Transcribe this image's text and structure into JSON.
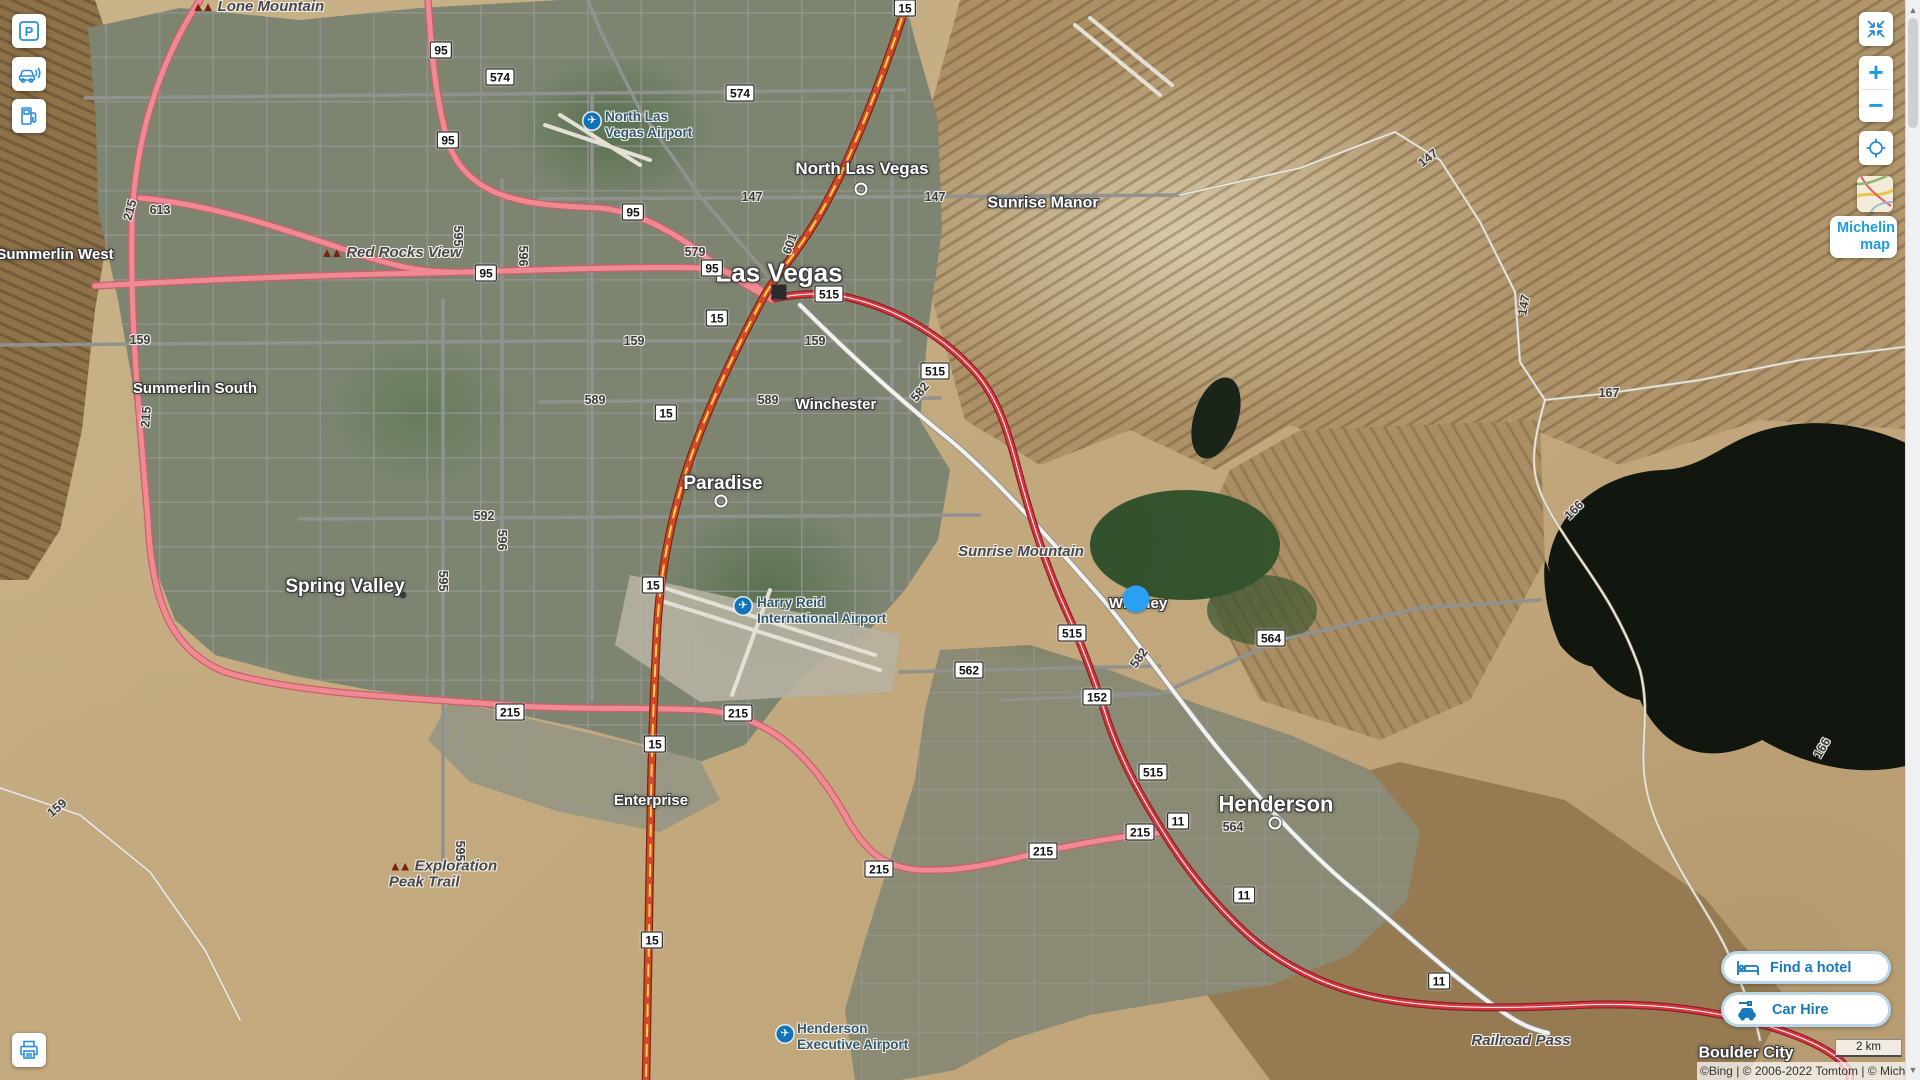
{
  "ui": {
    "left_toolbar": {
      "parking_tooltip": "Parking",
      "traffic_tooltip": "Traffic",
      "fuel_tooltip": "Petrol stations",
      "print_tooltip": "Print"
    },
    "right_toolbar": {
      "collapse_tooltip": "Collapse",
      "zoom_in_label": "+",
      "zoom_out_label": "−",
      "locate_tooltip": "My location",
      "map_style_label": "Michelin map"
    },
    "bottom_right": {
      "find_hotel_label": "Find a hotel",
      "car_hire_label": "Car Hire"
    },
    "scale_label": "2 km",
    "copyright": "©Bing | © 2006-2022 Tomtom | © Michelin"
  },
  "map": {
    "cities": [
      {
        "label": "Las Vegas",
        "x": 779,
        "y": 273,
        "fs": 26,
        "marker": {
          "t": "square",
          "x": 779,
          "y": 292
        }
      },
      {
        "label": "North Las Vegas",
        "x": 862,
        "y": 169,
        "fs": 17,
        "marker": {
          "t": "ring",
          "x": 861,
          "y": 189
        }
      },
      {
        "label": "Sunrise Manor",
        "x": 1043,
        "y": 204,
        "fs": 16,
        "marker": null
      },
      {
        "label": "Winchester",
        "x": 836,
        "y": 405,
        "fs": 15,
        "marker": null
      },
      {
        "label": "Paradise",
        "x": 723,
        "y": 484,
        "fs": 19,
        "marker": {
          "t": "ring",
          "x": 721,
          "y": 501
        }
      },
      {
        "label": "Spring Valley",
        "x": 345,
        "y": 587,
        "fs": 19,
        "marker": {
          "t": "dot",
          "x": 403,
          "y": 595
        }
      },
      {
        "label": "Summerlin West",
        "x": 55,
        "y": 255,
        "fs": 15,
        "marker": null
      },
      {
        "label": "Summerlin South",
        "x": 195,
        "y": 389,
        "fs": 15,
        "marker": null
      },
      {
        "label": "Whitney",
        "x": 1138,
        "y": 604,
        "fs": 15,
        "marker": null
      },
      {
        "label": "Enterprise",
        "x": 651,
        "y": 801,
        "fs": 15,
        "marker": null
      },
      {
        "label": "Henderson",
        "x": 1276,
        "y": 804,
        "fs": 22,
        "marker": {
          "t": "ring",
          "x": 1275,
          "y": 823
        }
      },
      {
        "label": "Boulder City",
        "x": 1746,
        "y": 1054,
        "fs": 16,
        "marker": null
      }
    ],
    "places": [
      {
        "lines": [
          "Lone Mountain"
        ],
        "x": 258,
        "y": 7,
        "icon": true
      },
      {
        "lines": [
          "Red Rocks View"
        ],
        "x": 391,
        "y": 253,
        "icon": true
      },
      {
        "lines": [
          "Sunrise Mountain"
        ],
        "x": 1021,
        "y": 552,
        "icon": false
      },
      {
        "lines": [
          "Exploration",
          "Peak Trail"
        ],
        "x": 443,
        "y": 874,
        "icon": true
      },
      {
        "lines": [
          "Railroad Pass"
        ],
        "x": 1521,
        "y": 1041,
        "icon": false
      }
    ],
    "airports": [
      {
        "lines": [
          "North Las",
          "Vegas Airport"
        ],
        "x": 605,
        "y": 109,
        "ix": 592,
        "iy": 121
      },
      {
        "lines": [
          "Harry Reid",
          "International Airport"
        ],
        "x": 757,
        "y": 595,
        "ix": 743,
        "iy": 606
      },
      {
        "lines": [
          "Henderson",
          "Executive Airport"
        ],
        "x": 797,
        "y": 1021,
        "ix": 785,
        "iy": 1034
      }
    ],
    "shields": [
      {
        "t": "15",
        "x": 905,
        "y": 8
      },
      {
        "t": "15",
        "x": 717,
        "y": 318
      },
      {
        "t": "15",
        "x": 666,
        "y": 413
      },
      {
        "t": "15",
        "x": 653,
        "y": 585
      },
      {
        "t": "15",
        "x": 655,
        "y": 744
      },
      {
        "t": "15",
        "x": 652,
        "y": 940
      },
      {
        "t": "95",
        "x": 441,
        "y": 50
      },
      {
        "t": "95",
        "x": 448,
        "y": 140
      },
      {
        "t": "95",
        "x": 633,
        "y": 212
      },
      {
        "t": "95",
        "x": 712,
        "y": 268
      },
      {
        "t": "95",
        "x": 486,
        "y": 273
      },
      {
        "t": "515",
        "x": 829,
        "y": 294
      },
      {
        "t": "515",
        "x": 935,
        "y": 371
      },
      {
        "t": "515",
        "x": 1072,
        "y": 633
      },
      {
        "t": "515",
        "x": 1153,
        "y": 772
      },
      {
        "t": "215",
        "x": 510,
        "y": 712
      },
      {
        "t": "215",
        "x": 738,
        "y": 713
      },
      {
        "t": "215",
        "x": 879,
        "y": 869
      },
      {
        "t": "215",
        "x": 1043,
        "y": 851
      },
      {
        "t": "215",
        "x": 1140,
        "y": 832
      },
      {
        "t": "11",
        "x": 1178,
        "y": 821
      },
      {
        "t": "11",
        "x": 1244,
        "y": 895
      },
      {
        "t": "11",
        "x": 1439,
        "y": 981
      },
      {
        "t": "562",
        "x": 969,
        "y": 670
      },
      {
        "t": "564",
        "x": 1271,
        "y": 638
      },
      {
        "t": "152",
        "x": 1097,
        "y": 697
      },
      {
        "t": "574",
        "x": 500,
        "y": 77
      },
      {
        "t": "574",
        "x": 740,
        "y": 93
      }
    ],
    "route_texts": [
      {
        "t": "147",
        "x": 752,
        "y": 197,
        "r": 0
      },
      {
        "t": "147",
        "x": 935,
        "y": 197,
        "r": 0
      },
      {
        "t": "147",
        "x": 1428,
        "y": 158,
        "r": -38
      },
      {
        "t": "147",
        "x": 1524,
        "y": 305,
        "r": -80
      },
      {
        "t": "159",
        "x": 140,
        "y": 340,
        "r": 0
      },
      {
        "t": "159",
        "x": 634,
        "y": 341,
        "r": 0
      },
      {
        "t": "159",
        "x": 815,
        "y": 341,
        "r": 0
      },
      {
        "t": "159",
        "x": 57,
        "y": 808,
        "r": -40
      },
      {
        "t": "579",
        "x": 695,
        "y": 252,
        "r": 0
      },
      {
        "t": "589",
        "x": 595,
        "y": 400,
        "r": 0
      },
      {
        "t": "589",
        "x": 768,
        "y": 400,
        "r": 0
      },
      {
        "t": "596",
        "x": 523,
        "y": 256,
        "r": 90
      },
      {
        "t": "596",
        "x": 502,
        "y": 540,
        "r": 90
      },
      {
        "t": "592",
        "x": 484,
        "y": 516,
        "r": 0
      },
      {
        "t": "595",
        "x": 458,
        "y": 236,
        "r": 90
      },
      {
        "t": "595",
        "x": 443,
        "y": 581,
        "r": 90
      },
      {
        "t": "595",
        "x": 460,
        "y": 851,
        "r": 90
      },
      {
        "t": "601",
        "x": 790,
        "y": 244,
        "r": -70
      },
      {
        "t": "582",
        "x": 920,
        "y": 392,
        "r": -50
      },
      {
        "t": "582",
        "x": 1139,
        "y": 658,
        "r": -55
      },
      {
        "t": "613",
        "x": 160,
        "y": 210,
        "r": 0
      },
      {
        "t": "215",
        "x": 130,
        "y": 210,
        "r": -75
      },
      {
        "t": "215",
        "x": 146,
        "y": 417,
        "r": -85
      },
      {
        "t": "167",
        "x": 1609,
        "y": 393,
        "r": 0
      },
      {
        "t": "166",
        "x": 1574,
        "y": 510,
        "r": -45
      },
      {
        "t": "166",
        "x": 1822,
        "y": 748,
        "r": -60
      },
      {
        "t": "564",
        "x": 1233,
        "y": 827,
        "r": 0
      }
    ],
    "geolocation_dot": {
      "x": 1136,
      "y": 599,
      "color": "#2b9ff2"
    }
  }
}
